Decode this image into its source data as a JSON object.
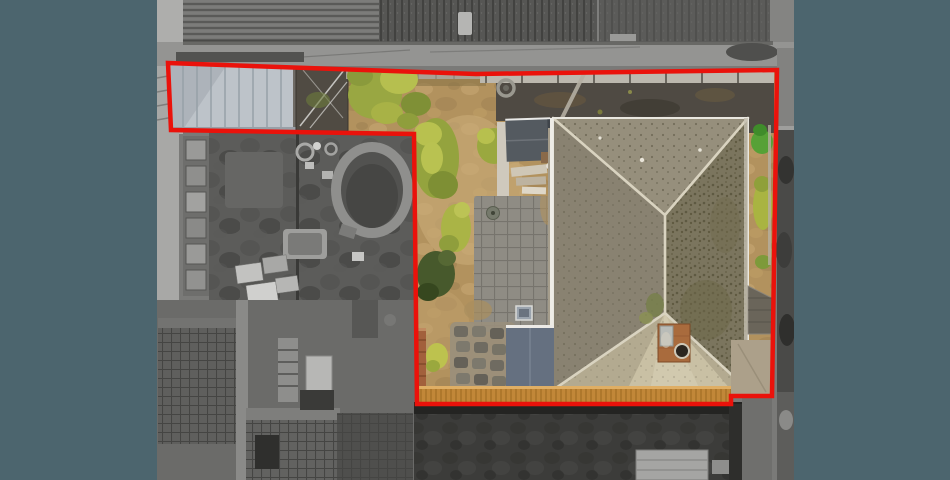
{
  "meta": {
    "alt": "Overhead drone photograph of a residential property. A red outline marks the property boundary; the land inside the outline (garage, garden, hipped-roof house, decking) is shown in colour while the neighbouring land outside the outline is desaturated grey. Dark slate bars letterbox the photo on the left and right."
  },
  "frame": {
    "background_color": "#4c656e",
    "photo_x": 157,
    "photo_width": 637
  },
  "boundary": {
    "stroke_color": "#ea120b",
    "stroke_width": 4.5,
    "points": "168,63 476,74 777,70 772,396 731,396 731,404 417,404 414,134 171,130"
  },
  "palette": {
    "soil_tan": "#b2925e",
    "soil_light": "#c9ab78",
    "bush_olive": "#99a742",
    "bush_bright": "#b8c14f",
    "bush_dark": "#47592c",
    "bush_vivid": "#56a136",
    "garage_roof": "#bdc3c9",
    "greenhouse_dark": "#504b43",
    "fence_wood": "#bcb8ae",
    "asphalt": "#4f4a43",
    "patio_paver": "#8f8c84",
    "outbuilding_roof": "#545a60",
    "house_roof_top": "#968f7c",
    "house_roof_left": "#898271",
    "house_roof_right": "#7b755e",
    "house_roof_bottom": "#b3aa90",
    "roof_ridge": "#d9d3c0",
    "chimney_brick": "#a96b3d",
    "shed_roof_blue": "#657080",
    "deck_wood": "#c18738",
    "brick_planter": "#a2603c",
    "grey_base": "#7a7a78",
    "grey_roof_mid": "#767674",
    "grey_roof_dark": "#565654",
    "grey_wall_light": "#aeaeac",
    "grey_pool_rim": "#8f8f8d",
    "grey_pool_water": "#525250",
    "grey_crate": "#5f5f5d",
    "grey_hedge": "#3c3c3a",
    "grey_driveway": "#4a4a48"
  }
}
